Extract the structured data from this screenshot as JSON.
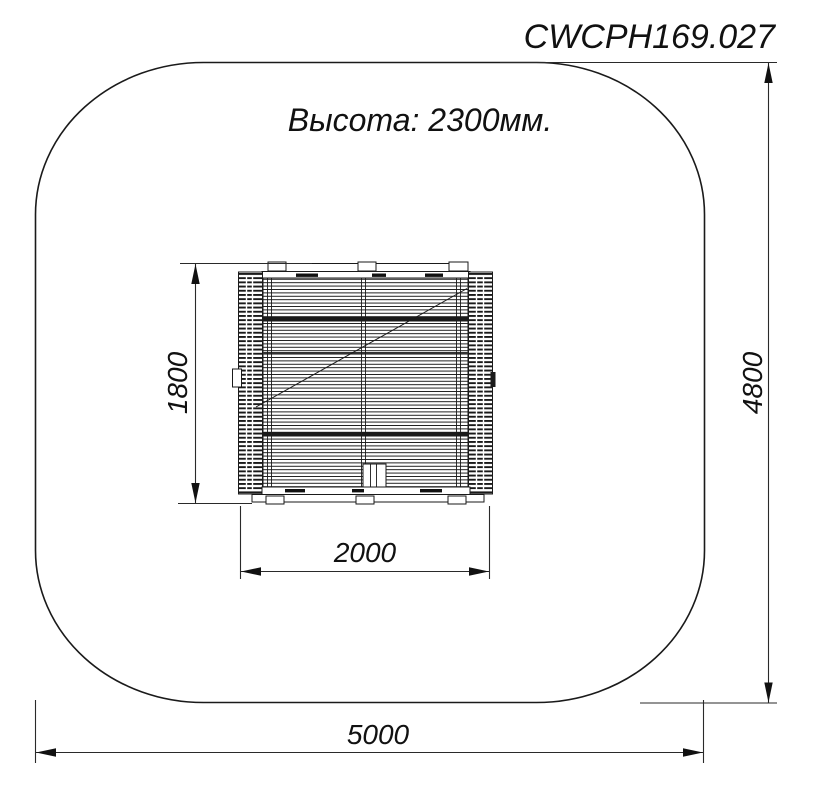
{
  "drawing": {
    "code": "CWCPH169.027",
    "height_note": "Высота: 2300мм.",
    "dims": {
      "equipment_depth": "1800",
      "equipment_width": "2000",
      "zone_depth": "4800",
      "zone_width": "5000"
    },
    "colors": {
      "line": "#1a1a1a",
      "background": "#ffffff"
    }
  }
}
